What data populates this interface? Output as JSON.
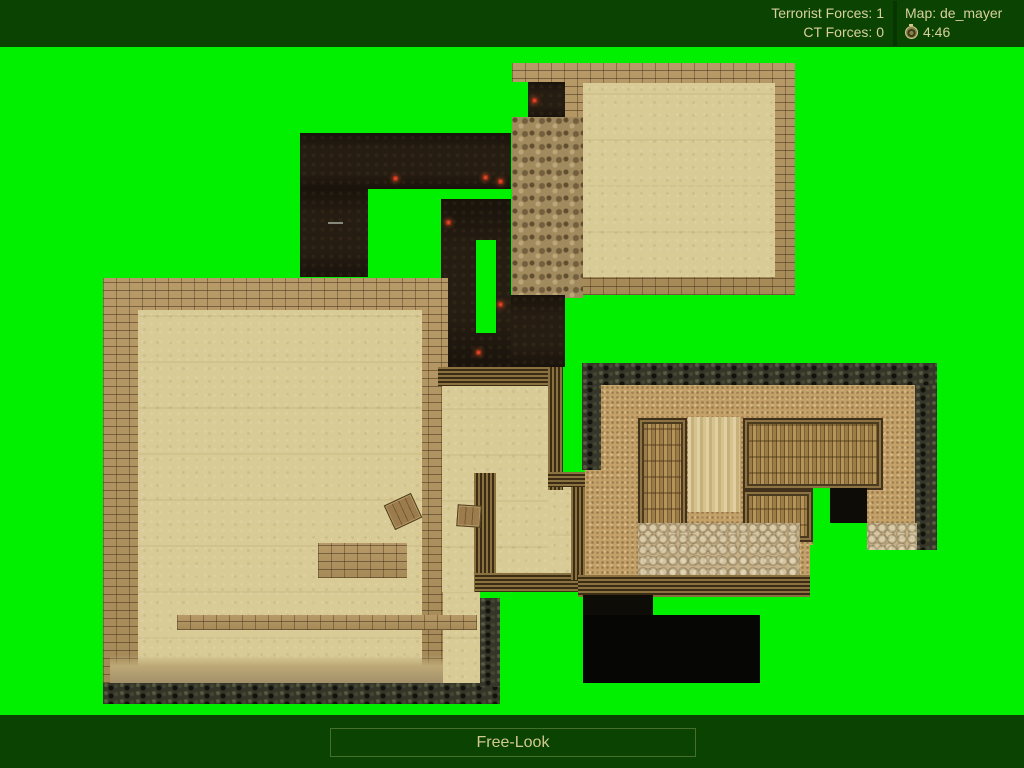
{
  "hud": {
    "terrorist_forces": {
      "label": "Terrorist Forces:",
      "value": "1"
    },
    "ct_forces": {
      "label": "CT Forces:",
      "value": "0"
    },
    "map": {
      "label": "Map:",
      "value": "de_mayer"
    },
    "timer": "4:46"
  },
  "footer": {
    "mode_label": "Free-Look"
  },
  "colors": {
    "hud_background": "#0b4402",
    "chroma_green": "#00f000",
    "hud_text": "#d8cf9d",
    "torch_red": "#c0381c"
  },
  "map_view": {
    "torches": [
      [
        395,
        178
      ],
      [
        485,
        177
      ],
      [
        500,
        181
      ],
      [
        448,
        222
      ],
      [
        500,
        304
      ],
      [
        478,
        352
      ],
      [
        534,
        100
      ]
    ]
  }
}
